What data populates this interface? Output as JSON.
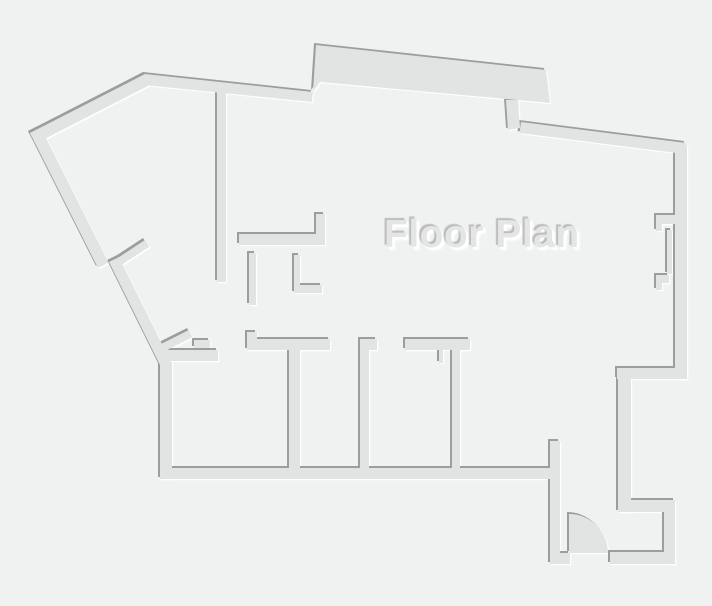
{
  "canvas": {
    "width": 712,
    "height": 606
  },
  "palette": {
    "background": "#f0f1f1",
    "wall_fill": "#e2e4e4",
    "wall_shadow": "#9d9d9d",
    "wall_highlight": "#ffffff",
    "title_fill": "#e4e5e5",
    "title_shadow_dark": "#bcbcbc",
    "title_shadow_light": "#ffffff"
  },
  "title": {
    "text": "Floor Plan"
  },
  "emboss": {
    "highlight_offset": 3.2,
    "fill_offset": 2
  },
  "walls": [
    {
      "name": "outer-top-left-diagonal",
      "path": "M143,72 L28,131 L33.5,141.7 L148.5,82.7 Z"
    },
    {
      "name": "outer-left-diagonal-upper",
      "path": "M28,131 L96,266 L106.7,260.6 L38.7,125.6 Z"
    },
    {
      "name": "outer-left-diagonal-lower",
      "path": "M107,260 L160,367 L169.9,362.1 L116.9,255.1 Z"
    },
    {
      "name": "door-jamb-left-upper",
      "path": "M108,261 L143,238 L147.4,244.7 L112.4,267.7 Z"
    },
    {
      "name": "outer-top",
      "path": "M143,72 L311,90 L310,100 L142,83 Z"
    },
    {
      "name": "outer-top-protrusion",
      "path": "M314,43 L544,68 L548,101 L318,80 L311,90 Z"
    },
    {
      "name": "protrusion-descender",
      "path": "M504,98 L516,98 L518,126 L506,128 Z"
    },
    {
      "name": "outer-top-right-diagonal",
      "path": "M519,120 L684,141 L682.5,152 L517.5,131 Z"
    },
    {
      "name": "outer-right",
      "path": "M673,143 L685,143 L685,377 L673,377 Z"
    },
    {
      "name": "window-jamb-upper",
      "path": "M654,213 L673,213 L673,222 L660,222 L660,229 L654,229 Z"
    },
    {
      "name": "window-pane",
      "path": "M665,228 L670,228 L670,272 L665,272 Z"
    },
    {
      "name": "window-jamb-lower",
      "path": "M654,273 L667,273 L667,281 L660,281 L660,288 L654,288 Z"
    },
    {
      "name": "outer-right-jog",
      "path": "M615,366 L685,366 L685,377 L615,377 Z"
    },
    {
      "name": "outer-right-lower",
      "path": "M616,366 L629,366 L629,510 L616,510 Z"
    },
    {
      "name": "entry-top",
      "path": "M616,498 L673,498 L673,510 L616,510 Z"
    },
    {
      "name": "entry-right",
      "path": "M662,505 L673,505 L673,562 L662,562 Z"
    },
    {
      "name": "entry-bottom",
      "path": "M608,550 L673,550 L673,562 L608,562 Z"
    },
    {
      "name": "entry-bottom-left",
      "path": "M548,551 L568,551 L568,562 L548,562 Z"
    },
    {
      "name": "vestibule-wall",
      "path": "M548,439 L558,439 L558,562 L548,562 Z"
    },
    {
      "name": "entry-door-swing",
      "path": "M567,512 A39,39 0 0 1 606,551 L567,551 Z"
    },
    {
      "name": "outer-bottom",
      "path": "M158,466 L552,466 L552,477 L158,477 Z"
    },
    {
      "name": "outer-left-lower",
      "path": "M158,360 L170,360 L170,477 L158,477 Z"
    },
    {
      "name": "door-jamb-left-lower",
      "path": "M155,344 L187,328 L190.6,335.2 L158.6,351.2 Z"
    },
    {
      "name": "room1-door-jamb",
      "path": "M192,338 L208,338 L208,346 L192,346 Z"
    },
    {
      "name": "room1-top",
      "path": "M160,348 L216,348 L216,359 L160,359 Z"
    },
    {
      "name": "room1-bar-step",
      "path": "M245,330 L255,330 L255,338 L245,338 Z"
    },
    {
      "name": "room1-bar",
      "path": "M245,337 L328,337 L328,348 L245,348 Z"
    },
    {
      "name": "room-divider-1",
      "path": "M287,348 L298,348 L298,468 L287,468 Z"
    },
    {
      "name": "room2-bar",
      "path": "M358,337 L375,337 L375,348 L358,348 Z"
    },
    {
      "name": "room-divider-2",
      "path": "M358,348 L367,348 L367,468 L358,468 Z"
    },
    {
      "name": "room3-bar",
      "path": "M403,337 L468,337 L468,348 L403,348 Z"
    },
    {
      "name": "room-divider-3",
      "path": "M450,348 L458,348 L458,468 L450,468 Z"
    },
    {
      "name": "room3-door-leaf",
      "path": "M437,348 L441,348 L441,361 L437,361 Z"
    },
    {
      "name": "hall-divider",
      "path": "M215,84 L224,84 L224,280 L215,280 Z"
    },
    {
      "name": "closet-top",
      "path": "M237,232 L316,232 L316,243 L237,243 Z"
    },
    {
      "name": "closet-stub-right",
      "path": "M314,212 L323,212 L323,243 L314,243 Z"
    },
    {
      "name": "closet-stub-a",
      "path": "M247,251 L254,251 L254,303 L247,303 Z"
    },
    {
      "name": "closet-stub-b",
      "path": "M292,253 L298,253 L298,291 L292,291 Z"
    },
    {
      "name": "closet-stub-b-foot",
      "path": "M298,283 L320,283 L320,291 L298,291 Z"
    }
  ]
}
